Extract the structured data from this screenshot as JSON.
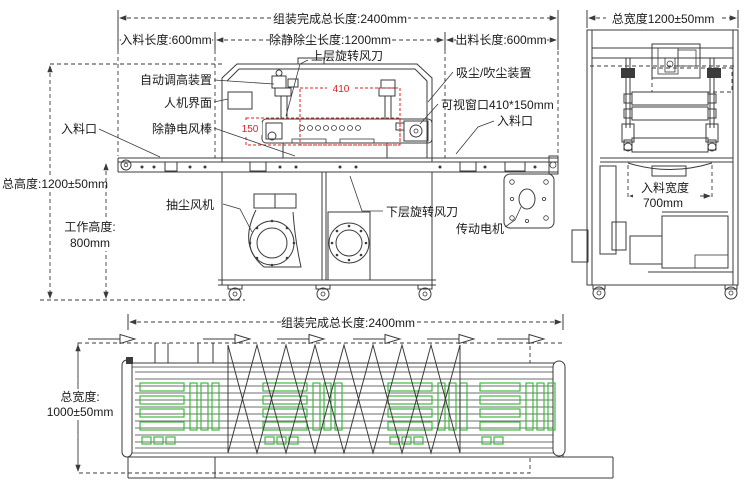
{
  "colors": {
    "line": "#3b3b3b",
    "dim_red": "#dd2020",
    "panel_green": "#3cbb3c",
    "background": "#ffffff"
  },
  "front_view": {
    "dims": {
      "total_length": "组装完成总长度:2400mm",
      "infeed_length": "入料长度:600mm",
      "clean_length": "除静除尘长度:1200mm",
      "outfeed_length": "出料长度:600mm",
      "total_height": "总高度:1200±50mm",
      "work_height_label": "工作高度:",
      "work_height_value": "800mm",
      "window_width_mm": "410",
      "window_height_mm": "150"
    },
    "callouts": {
      "upper_air_knife": "上层旋转风刀",
      "auto_height_device": "自动调高装置",
      "hmi": "人机界面",
      "infeed_port_left": "入料口",
      "static_bar": "除静电风棒",
      "suction_blow_device": "吸尘/吹尘装置",
      "viewing_window": "可视窗口410*150mm",
      "infeed_port_right": "入料口",
      "lower_air_knife": "下层旋转风刀",
      "drive_motor": "传动电机",
      "dust_extraction_fan": "抽尘风机"
    }
  },
  "side_view": {
    "dims": {
      "total_width": "总宽度1200±50mm",
      "infeed_width_label": "入料宽度",
      "infeed_width_value": "700mm"
    }
  },
  "top_view": {
    "dims": {
      "total_length": "组装完成总长度:2400mm",
      "total_width_label": "总宽度:",
      "total_width_value": "1000±50mm"
    }
  }
}
